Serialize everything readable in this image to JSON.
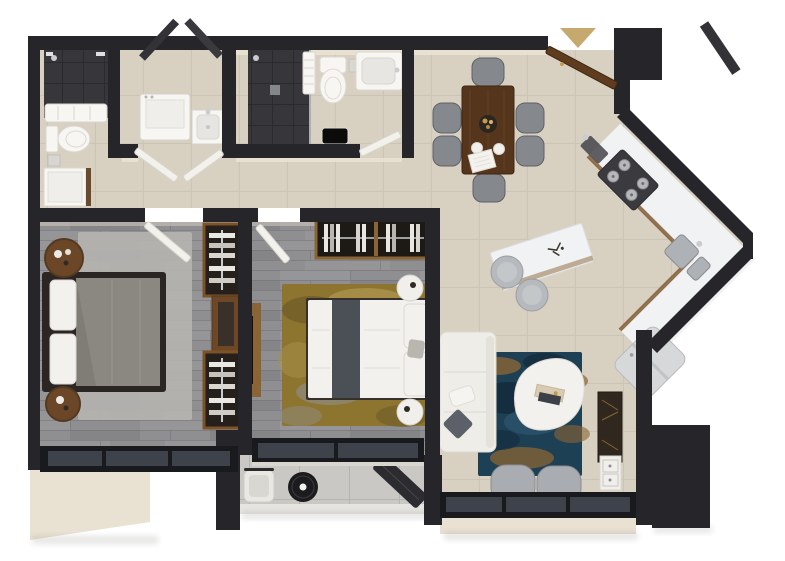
{
  "canvas": {
    "width": 785,
    "height": 561
  },
  "scene": {
    "label": "two-bedroom apartment 3D floor plan, top-down render",
    "entrance_marker": "beige triangle arrow at entry door"
  },
  "palette": {
    "background": "#ffffff",
    "wall": "#26262a",
    "wall_face": "#e9e1d2",
    "tile": "#d8d1c2",
    "tile_grout": "#c3bbaa",
    "wood_floor": "#8f8f92",
    "wood_line": "#6f6f73",
    "dark_tile": "#36363b",
    "dark_tile_line": "#2b2b2f",
    "marble": "#f1f2f4",
    "counter_wood": "#7a5328",
    "rug_master": "#b4b3b0",
    "rug_gold": "#8d742f",
    "rug_gold_patch": "#6e5b28",
    "rug_gold_light": "#b59d58",
    "rug_blue": "#1e4054",
    "rug_blue_dark": "#12293a",
    "rug_blue_light": "#2f5a74",
    "bed_frame": "#2b2624",
    "bed_duvet": "#8b8781",
    "linen": "#f3f1ee",
    "runner_gray": "#4b4f56",
    "sofa": "#efede7",
    "pillow_gray": "#5c6068",
    "chair_gray": "#85888d",
    "armchair": "#a9acb1",
    "table_wood": "#55351c",
    "console_wood": "#30271f",
    "cabinet_white": "#f1efec",
    "stool": "#b6b9bd",
    "window_frame": "#191a1e",
    "window_glass": "#3e434b",
    "threshold": "#d9d6cf",
    "balcony_floor": "#c9c8c4",
    "railing": "#e6e4e0",
    "fixture": "#f7f6f3",
    "fixture_shade": "#e7e6e2",
    "steel": "#caccd0",
    "appliance_dark": "#3a3a3f",
    "fridge": "#d7d8da",
    "door_white": "#f3f1ec",
    "door_wood": "#5f3c1e",
    "door_dark": "#323237",
    "gold_accent": "#8a6434",
    "arrow_tan": "#c5a96f",
    "nightstand_wood": "#6b4728",
    "wardrobe_frame": "#7c5228",
    "wardrobe_dark": "#25201b",
    "face_cream": "#ebe3d3"
  },
  "rooms": [
    {
      "name": "bathroom-1",
      "furniture": [
        "dark-tile shower",
        "towel shelf",
        "toilet",
        "shower tray",
        "wood trim"
      ]
    },
    {
      "name": "laundry",
      "furniture": [
        "washing machine",
        "utility sink",
        "double doors"
      ]
    },
    {
      "name": "bathroom-2",
      "furniture": [
        "dark-tile shower",
        "towel rack",
        "toilet",
        "bathtub vanity",
        "bath mat",
        "door"
      ]
    },
    {
      "name": "hallway",
      "furniture": [
        "bedroom doors",
        "tile floor"
      ]
    },
    {
      "name": "master-bedroom",
      "furniture": [
        "double bed",
        "round nightstand x2",
        "gray area rug",
        "open wardrobe x2",
        "dresser",
        "window wall"
      ]
    },
    {
      "name": "bedroom-2",
      "furniture": [
        "double bed",
        "round nightstand x2",
        "gold rug",
        "wardrobe",
        "wall tv panel",
        "balcony slider"
      ]
    },
    {
      "name": "balcony",
      "furniture": [
        "lounge chair",
        "round black table",
        "bench",
        "railing"
      ]
    },
    {
      "name": "dining",
      "furniture": [
        "wood dining table",
        "chair x6",
        "tray with bottles",
        "plates",
        "napkin"
      ]
    },
    {
      "name": "kitchen",
      "furniture": [
        "L-shaped counter",
        "gas stove 4 burners",
        "double sink",
        "prep faucet",
        "marble island",
        "stool x2",
        "fridge"
      ]
    },
    {
      "name": "living",
      "furniture": [
        "white sofa",
        "blue-gold rug",
        "organic coffee table",
        "armchair x2",
        "tv console",
        "media cabinet",
        "window wall"
      ]
    },
    {
      "name": "entrance",
      "furniture": [
        "entry door",
        "direction arrow",
        "utility door leaves"
      ]
    }
  ]
}
